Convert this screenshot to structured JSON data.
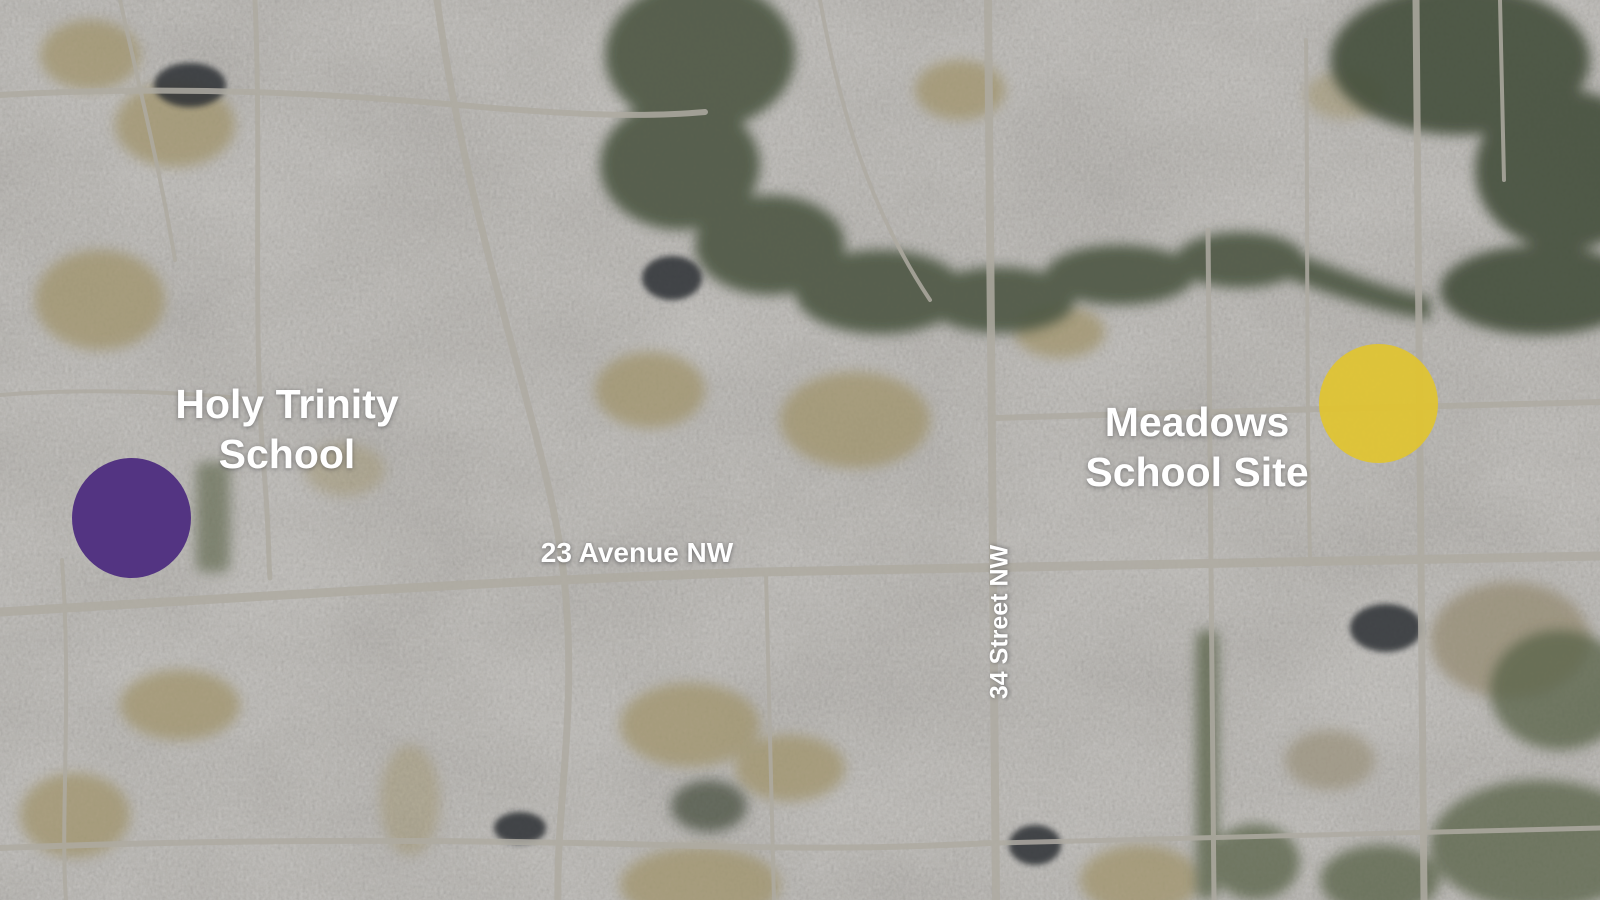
{
  "map": {
    "site_labels": [
      {
        "line1": "Holy Trinity",
        "line2": "School"
      },
      {
        "line1": "Meadows",
        "line2": "School Site"
      }
    ],
    "street_labels": {
      "avenue": "23 Avenue NW",
      "street": "34 Street NW"
    },
    "markers": [
      {
        "name": "holy-trinity-school",
        "color": "#4F2F80"
      },
      {
        "name": "meadows-school-site",
        "color": "#E0C430"
      }
    ]
  }
}
